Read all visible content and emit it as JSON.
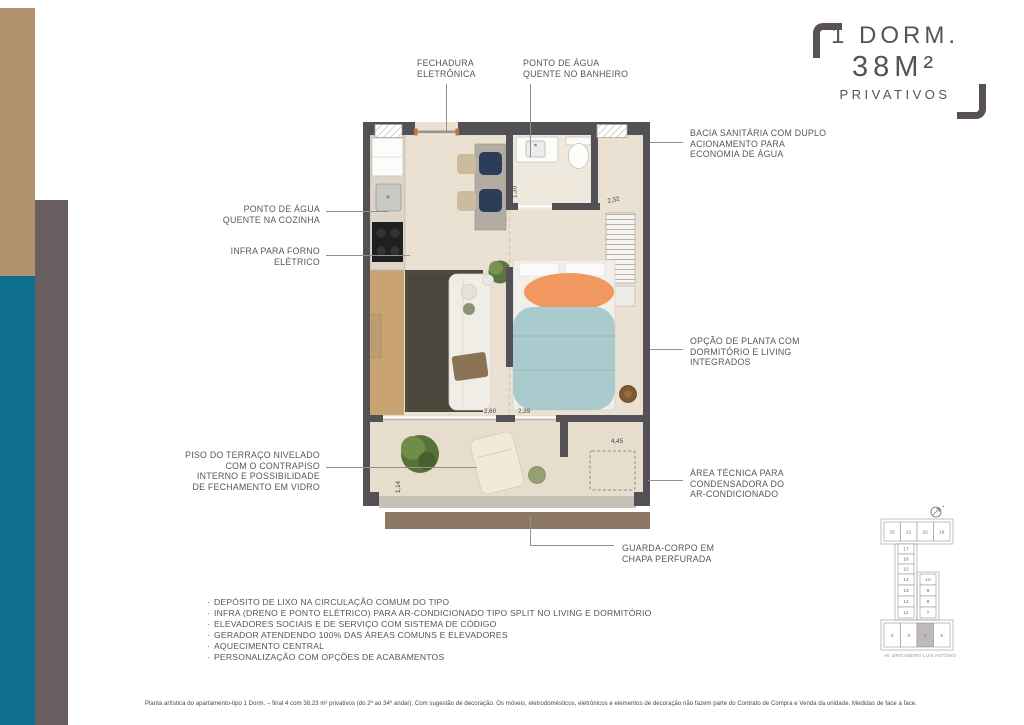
{
  "accents": {
    "tan_bar": "#b2926e",
    "teal_bar": "#0e6e8e",
    "gray_bar": "#685d60",
    "title_color": "#585254",
    "wall_color": "#545156",
    "floor_color": "#eae1d2",
    "orange_blanket": "#f0985f",
    "teal_throw": "#a9cbce"
  },
  "title": {
    "line1": "1 DORM.",
    "line2": "38M²",
    "line3": "PRIVATIVOS"
  },
  "callouts": {
    "fechadura": "FECHADURA\nELETRÔNICA",
    "agua_banheiro": "PONTO DE ÁGUA\nQUENTE NO BANHEIRO",
    "bacia": "BACIA SANITÁRIA COM DUPLO\nACIONAMENTO PARA\nECONOMIA DE ÁGUA",
    "agua_cozinha": "PONTO DE ÁGUA\nQUENTE NA COZINHA",
    "forno": "INFRA PARA FORNO\nELÉTRICO",
    "opcao": "OPÇÃO DE PLANTA COM\nDORMITÓRIO E LIVING\nINTEGRADOS",
    "piso": "PISO DO TERRAÇO NIVELADO\nCOM O CONTRAPISO\nINTERNO E POSSIBILIDADE\nDE FECHAMENTO EM VIDRO",
    "area_tecnica": "ÁREA TÉCNICA PARA\nCONDENSADORA DO\nAR-CONDICIONADO",
    "guarda_corpo": "GUARDA-CORPO EM\nCHAPA PERFURADA"
  },
  "features": [
    "DEPÓSITO DE LIXO NA CIRCULAÇÃO COMUM DO TIPO",
    "INFRA (DRENO E PONTO ELÉTRICO) PARA AR-CONDICIONADO TIPO SPLIT NO LIVING E DORMITÓRIO",
    "ELEVADORES SOCIAIS E DE SERVIÇO COM SISTEMA DE CÓDIGO",
    "GERADOR ATENDENDO 100% DAS ÁREAS COMUNS E ELEVADORES",
    "AQUECIMENTO CENTRAL",
    "PERSONALIZAÇÃO COM OPÇÕES DE ACABAMENTOS"
  ],
  "disclaimer": "Planta artística do apartamento-tipo 1 Dorm. – final 4 com 38,23 m² privativos (do 2º ao 34º andar). Com sugestão de decoração. Os móveis, eletrodomésticos, eletrônicos e elementos de decoração não fazem parte do Contrato de Compra e Venda da unidade. Medidas de face a face.",
  "plan": {
    "dims": {
      "kitchen": "6,34",
      "bath": "1,30",
      "closet": "2,32",
      "living": "2,60",
      "bedroom": "2,39",
      "terrace": "4,45",
      "depth": "1,14"
    }
  },
  "keyplan": {
    "street": "AV. BRIGADEIRO LUIS ANTÔNIO",
    "north_icon": "north-arrow",
    "top_row": [
      "20",
      "21",
      "22",
      "19"
    ],
    "stem": [
      "17",
      "16",
      "15"
    ],
    "left_col": [
      "14",
      "13",
      "12",
      "11"
    ],
    "right_col": [
      "10",
      "9",
      "8",
      "7"
    ],
    "bottom_row": [
      "2",
      "3",
      "4",
      "5"
    ],
    "highlighted_unit": "4"
  }
}
